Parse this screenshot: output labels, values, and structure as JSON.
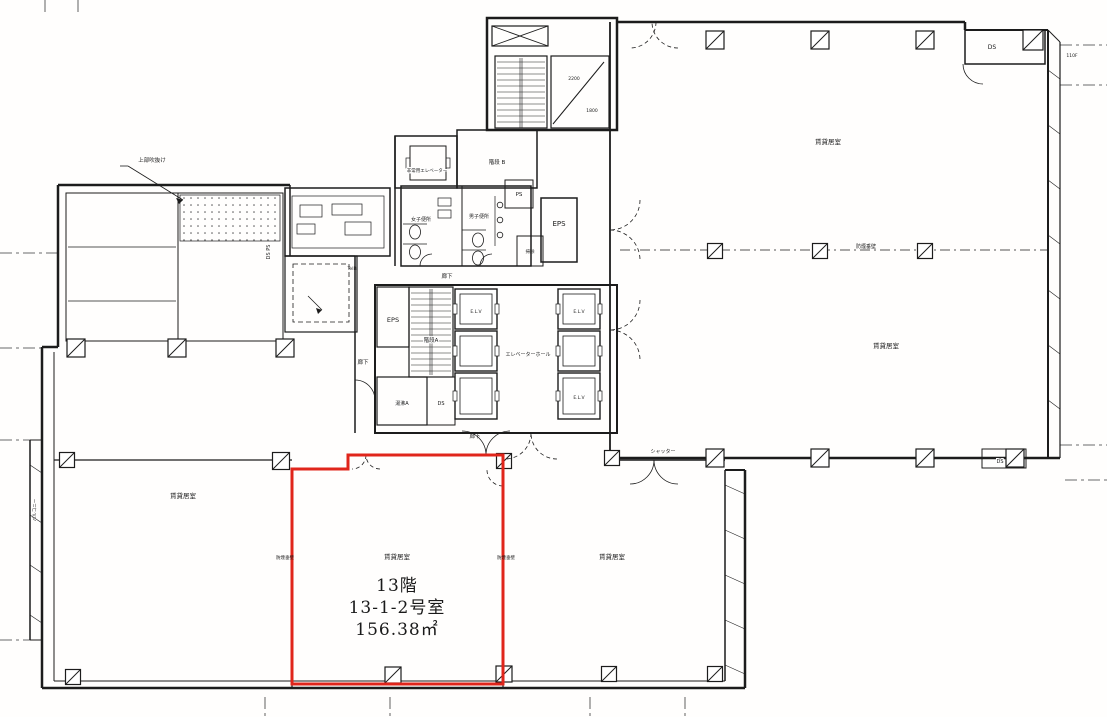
{
  "highlight": {
    "border_color": "#e0251b",
    "floor_label": "13階",
    "room_label": "13-1-2号室",
    "area_label": "156.38㎡"
  },
  "ink_color": "#1c1c1c",
  "labels": [
    {
      "name": "highlight-floor-label",
      "text": "13階",
      "x": 397,
      "y": 591,
      "size": 17,
      "serif": true
    },
    {
      "name": "highlight-room-label",
      "text": "13-1-2号室",
      "x": 397,
      "y": 613,
      "size": 17,
      "serif": true
    },
    {
      "name": "highlight-area-label",
      "text": "156.38㎡",
      "x": 397,
      "y": 635,
      "size": 17,
      "serif": true
    },
    {
      "name": "room-rental-upper-1",
      "text": "賃貸居室",
      "x": 828,
      "y": 144,
      "size": 6.5
    },
    {
      "name": "room-rental-upper-2",
      "text": "賃貸居室",
      "x": 886,
      "y": 348,
      "size": 6.5
    },
    {
      "name": "room-rental-lower-left",
      "text": "賃貸居室",
      "x": 183,
      "y": 498,
      "size": 6.5
    },
    {
      "name": "room-rental-highlight",
      "text": "賃貸居室",
      "x": 397,
      "y": 559,
      "size": 6.5
    },
    {
      "name": "room-rental-lower-right",
      "text": "賃貸居室",
      "x": 612,
      "y": 559,
      "size": 6.5
    },
    {
      "name": "label-smoke-barrier-1",
      "text": "防煙垂壁",
      "x": 866,
      "y": 248,
      "size": 5
    },
    {
      "name": "label-smoke-barrier-2",
      "text": "防煙垂壁",
      "x": 285,
      "y": 559,
      "size": 4.5
    },
    {
      "name": "label-smoke-barrier-3",
      "text": "防煙垂壁",
      "x": 506,
      "y": 559,
      "size": 4.5
    },
    {
      "name": "label-shutter",
      "text": "シャッター",
      "x": 663,
      "y": 453,
      "size": 5
    },
    {
      "name": "label-elevator-hall",
      "text": "エレベーターホール",
      "x": 528,
      "y": 356,
      "size": 5
    },
    {
      "name": "label-elv-1",
      "text": "E.L.V",
      "x": 476,
      "y": 313,
      "size": 4.5
    },
    {
      "name": "label-elv-2",
      "text": "E.L.V",
      "x": 579,
      "y": 313,
      "size": 4.5
    },
    {
      "name": "label-elv-3",
      "text": "E.L.V",
      "x": 579,
      "y": 399,
      "size": 4.5
    },
    {
      "name": "label-stairs-a",
      "text": "階段A",
      "x": 431,
      "y": 342,
      "size": 5.5,
      "halo": true
    },
    {
      "name": "label-stairs-b",
      "text": "階段 B",
      "x": 497,
      "y": 164,
      "size": 5.5
    },
    {
      "name": "label-eps-1",
      "text": "EPS",
      "x": 559,
      "y": 226,
      "size": 7
    },
    {
      "name": "label-eps-2",
      "text": "EPS",
      "x": 393,
      "y": 322,
      "size": 6.5
    },
    {
      "name": "label-ps",
      "text": "PS",
      "x": 519,
      "y": 196,
      "size": 5.5
    },
    {
      "name": "label-yuwakashi",
      "text": "湯沸A",
      "x": 402,
      "y": 405,
      "size": 5,
      "halo": true
    },
    {
      "name": "label-ds-core",
      "text": "DS",
      "x": 441,
      "y": 405,
      "size": 5
    },
    {
      "name": "label-ds-top-right",
      "text": "DS",
      "x": 992,
      "y": 49,
      "size": 6
    },
    {
      "name": "label-ds-lower-right",
      "text": "DS",
      "x": 1000,
      "y": 463,
      "size": 5,
      "halo": true
    },
    {
      "name": "label-ds-ps-left",
      "text": "DS PS",
      "x": 270,
      "y": 252,
      "size": 5,
      "rotate": -90
    },
    {
      "name": "label-womens-toilet",
      "text": "女子便所",
      "x": 421,
      "y": 221,
      "size": 5
    },
    {
      "name": "label-mens-toilet",
      "text": "男子便所",
      "x": 479,
      "y": 218,
      "size": 5
    },
    {
      "name": "label-cleaning",
      "text": "掃除",
      "x": 530,
      "y": 253,
      "size": 4.5
    },
    {
      "name": "label-corridor-1",
      "text": "廊下",
      "x": 447,
      "y": 278,
      "size": 5.5
    },
    {
      "name": "label-corridor-2",
      "text": "廊下",
      "x": 363,
      "y": 364,
      "size": 5.5
    },
    {
      "name": "label-corridor-3",
      "text": "廊下",
      "x": 475,
      "y": 438,
      "size": 5.5
    },
    {
      "name": "label-emergency-elevator",
      "text": "非常用エレベーター",
      "x": 427,
      "y": 172,
      "size": 4.5,
      "halo": true
    },
    {
      "name": "label-balcony",
      "text": "バルコニー",
      "x": 36,
      "y": 510,
      "size": 4.5,
      "rotate": -90
    },
    {
      "name": "label-void-annotation",
      "text": "上部吹抜け",
      "x": 152,
      "y": 162,
      "size": 5.5
    },
    {
      "name": "dim-2200",
      "text": "2200",
      "x": 574,
      "y": 80,
      "size": 4.5,
      "color": "#333333"
    },
    {
      "name": "dim-1800",
      "text": "1800",
      "x": 592,
      "y": 112,
      "size": 4.5,
      "color": "#333333"
    },
    {
      "name": "label-telb",
      "text": "TelB",
      "x": 352,
      "y": 270,
      "size": 4.5,
      "color": "#333333"
    },
    {
      "name": "label-rdf",
      "text": "110F",
      "x": 1072,
      "y": 57,
      "size": 4.5,
      "color": "#333333"
    }
  ]
}
